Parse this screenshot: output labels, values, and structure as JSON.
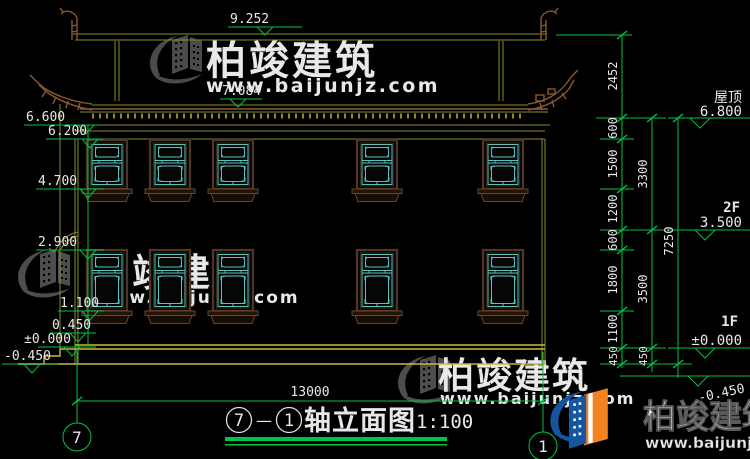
{
  "title_block": {
    "axis_start": "7",
    "axis_dash": "—",
    "axis_end": "1",
    "name": "轴立面图",
    "scale": "1:100"
  },
  "axes": {
    "left_bubble": "7",
    "right_bubble": "1"
  },
  "top_levels": {
    "ridge": "9.252",
    "eave": "7.084"
  },
  "left_levels": [
    "6.600",
    "6.200",
    "4.700",
    "2.900",
    "1.100",
    "0.450",
    "±0.000",
    "-0.450"
  ],
  "right_levels": [
    {
      "name": "屋顶",
      "value": "6.800"
    },
    {
      "name": "2F",
      "value": "3.500"
    },
    {
      "name": "1F",
      "value": "±0.000"
    },
    {
      "name": "",
      "value": "-0.450"
    }
  ],
  "dimensions": {
    "chain_inner": [
      "2452",
      "600",
      "1500",
      "1200",
      "600",
      "1800",
      "1100",
      "450"
    ],
    "chain_middle": [
      "3300",
      "3500",
      "450"
    ],
    "chain_outer": [
      "7250"
    ],
    "overall_width": "13000"
  },
  "watermark": {
    "brand": "柏竣建筑",
    "url": "www.baijunjz.com"
  },
  "colors": {
    "background": "#000000",
    "dimension_green": "#00c244",
    "cad_yellow": "#c9b93e",
    "cad_olive": "#8a8a2e",
    "window_teal": "#58c4bc",
    "wood_brown": "#8a5a2b",
    "watermark_gray": "#4d4d4d",
    "logo_blue": "#1456a0",
    "logo_orange": "#f58220"
  }
}
